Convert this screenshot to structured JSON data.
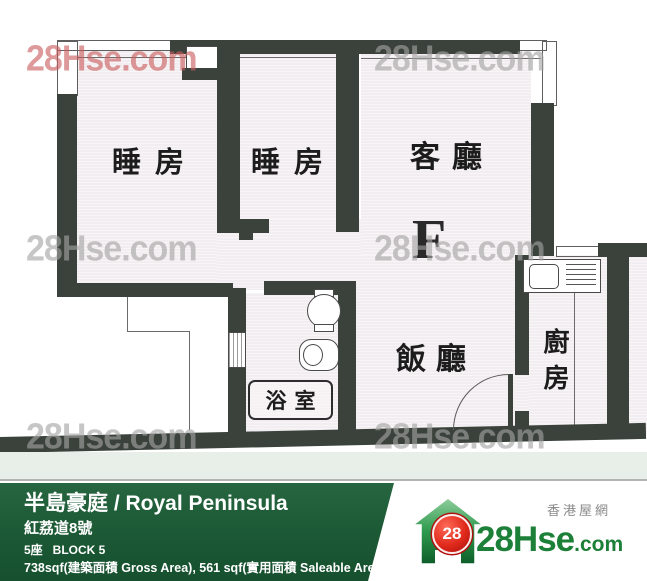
{
  "watermark": {
    "text": "28Hse.com"
  },
  "floor_plan": {
    "unit_letter": "F",
    "rooms": [
      {
        "id": "bedroom-1",
        "label": "睡房"
      },
      {
        "id": "bedroom-2",
        "label": "睡房"
      },
      {
        "id": "living-room",
        "label": "客廳"
      },
      {
        "id": "dining-room",
        "label": "飯廳"
      },
      {
        "id": "kitchen",
        "label": "廚房"
      },
      {
        "id": "bathroom",
        "label": "浴室"
      }
    ],
    "fixtures": [
      "kitchen-sink-unit",
      "bathroom-sink",
      "toilet",
      "door-swing",
      "entrance-door",
      "window"
    ]
  },
  "info_bar": {
    "title": "半島豪庭 / Royal Peninsula",
    "address": "紅荔道8號",
    "block": "5座   BLOCK 5",
    "area": "738sqf(建築面積 Gross Area), 561 sqf(實用面積 Saleable Area)",
    "bg_color": "#1d5a36"
  },
  "logo": {
    "badge": "28",
    "name": "28Hse",
    "tld": ".com",
    "tagline": "香港屋網",
    "green": "#1d8038",
    "red": "#cf1d1d"
  }
}
